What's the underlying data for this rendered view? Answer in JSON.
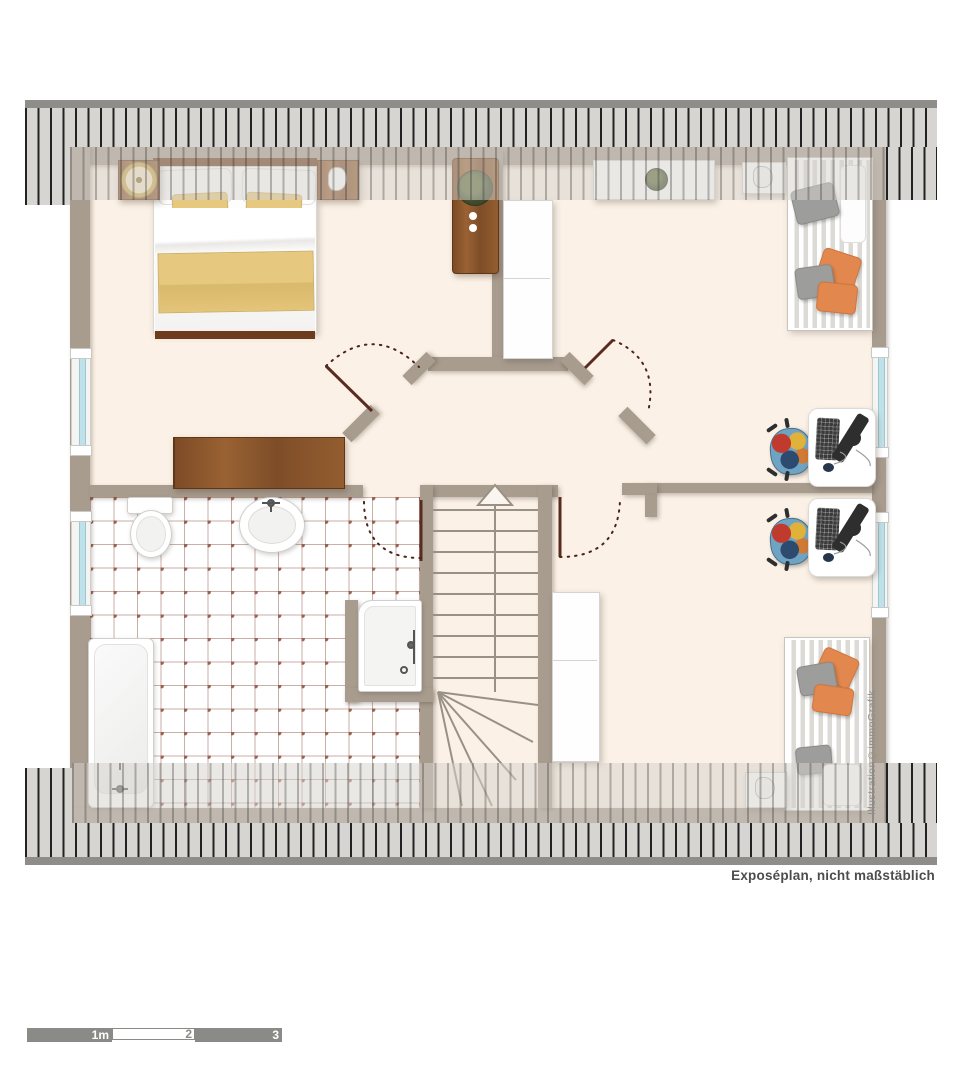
{
  "annotation": {
    "caption": "Exposéplan, nicht maßstäblich",
    "watermark": "Illustration©immoGrafik"
  },
  "scale_bar": {
    "labels": [
      "1m",
      "2",
      "3"
    ],
    "meters_total": 3
  },
  "colors": {
    "floor": "#fbf1e6",
    "wall": "#a89c8f",
    "roof_band": "#d7d5d2",
    "roof_cap": "#8f8d89",
    "tile_dot": "#9b6052",
    "wood": "#8a5a33",
    "pillow_orange": "#e2874e",
    "blanket_yellow": "#e6c87f",
    "window_glass": "#bfe2ea",
    "door_leaf": "#5a2b20"
  },
  "rooms": [
    {
      "name": "bedroom"
    },
    {
      "name": "hallway"
    },
    {
      "name": "bathroom"
    },
    {
      "name": "room-north-east"
    },
    {
      "name": "room-south-east"
    },
    {
      "name": "staircase"
    }
  ],
  "furniture": [
    "double-bed",
    "nightstand-left",
    "nightstand-right",
    "lamp",
    "dresser",
    "plant-cabinet",
    "tall-cabinet",
    "sideboard-with-plant",
    "wall-shelf",
    "single-bed-north",
    "single-bed-south",
    "desk-with-computer-north",
    "desk-with-computer-south",
    "office-chair-north",
    "office-chair-south",
    "toilet",
    "sink",
    "bathtub",
    "shower",
    "stairs-cabinet",
    "small-shelf-south"
  ]
}
